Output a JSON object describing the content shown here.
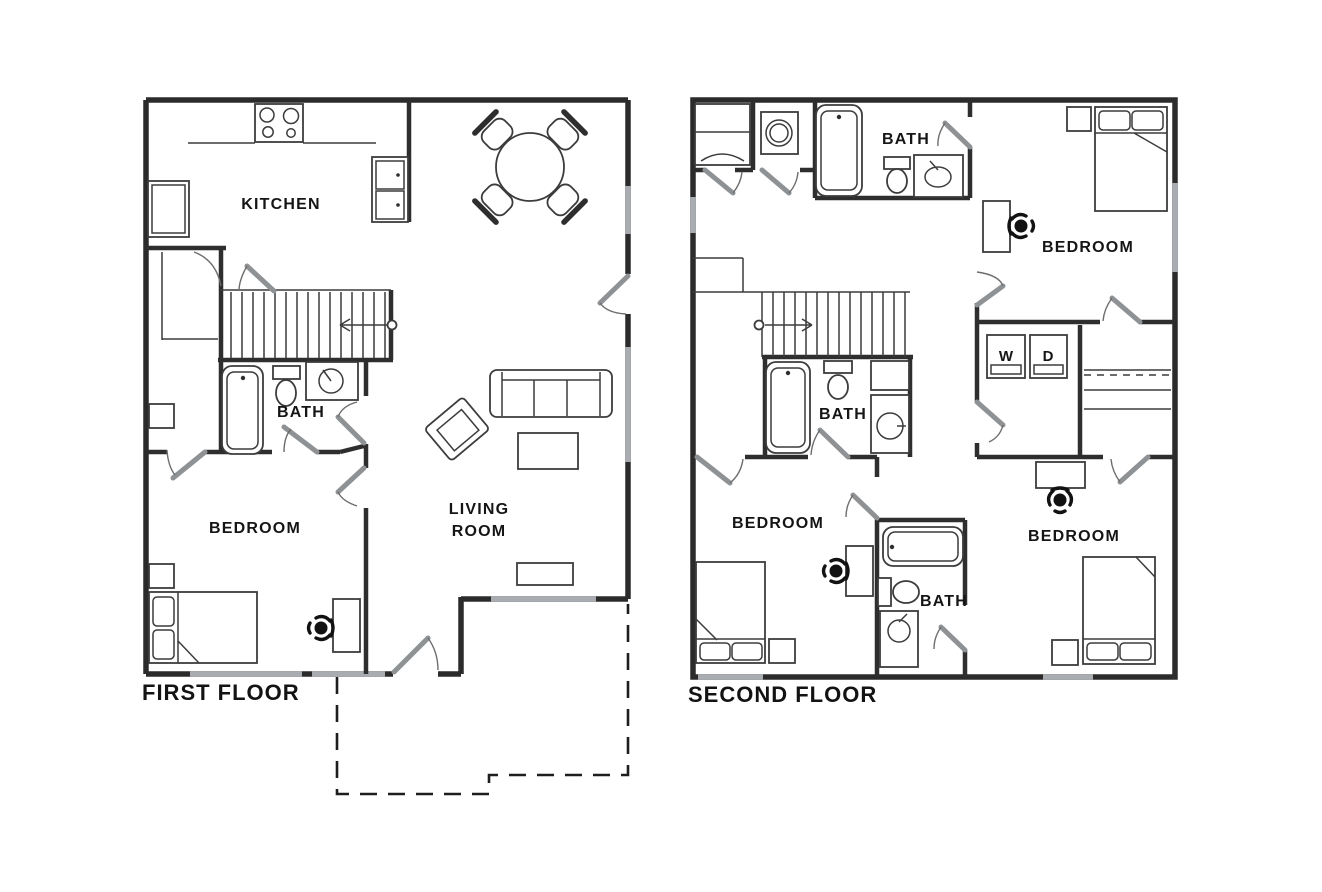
{
  "page": {
    "background_color": "#ffffff",
    "wall_color": "#2b2b2b",
    "window_color": "#a9adb1",
    "door_leaf_color": "#8f9295"
  },
  "floors": [
    {
      "title": "FIRST FLOOR",
      "rooms": [
        {
          "label": "KITCHEN"
        },
        {
          "label": "BATH"
        },
        {
          "label": "BEDROOM"
        },
        {
          "label": "LIVING ROOM",
          "lines": [
            "LIVING",
            "ROOM"
          ]
        }
      ],
      "features": [
        "stairs-up-arrow",
        "dashed-patio-outline",
        "dining-table-4-chairs",
        "sofa",
        "armchair",
        "bed",
        "desk-chair",
        "stove",
        "double-sink",
        "fridge",
        "bathtub",
        "toilet",
        "vanity-sink"
      ]
    },
    {
      "title": "SECOND FLOOR",
      "rooms": [
        {
          "label": "BATH"
        },
        {
          "label": "BEDROOM"
        },
        {
          "label": "BATH"
        },
        {
          "label": "BEDROOM"
        },
        {
          "label": "BATH"
        },
        {
          "label": "BEDROOM"
        }
      ],
      "appliances": [
        {
          "label": "W"
        },
        {
          "label": "D"
        }
      ],
      "features": [
        "stairs-up-arrow",
        "shower",
        "linen-closet-shelves",
        "three-bathtubs",
        "beds",
        "desk-chairs"
      ]
    }
  ]
}
